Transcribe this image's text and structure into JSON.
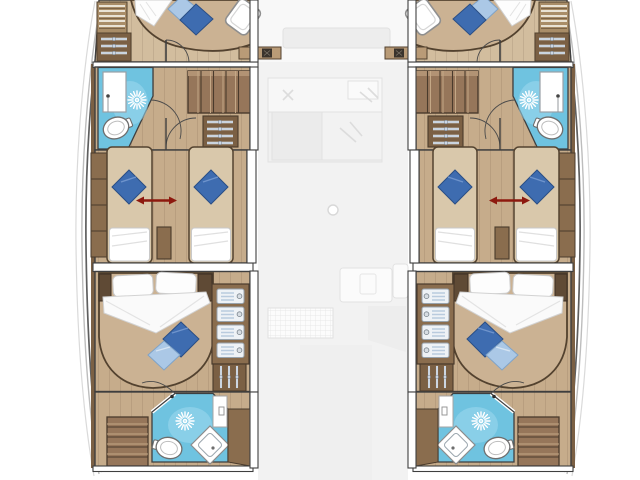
{
  "diagram": {
    "kind": "yacht-floor-plan",
    "vessel": "catamaran",
    "view": "lower deck, top view",
    "layout": "4 cabins / 4 bathrooms, symmetric port and starboard hulls, center saloon shown faded"
  },
  "colors": {
    "background": "#ffffff",
    "floor_wood": "#c6ac8b",
    "floor_wood_light": "#d2bd9e",
    "bed_platform": "#cbb293",
    "mattress_tan": "#d9c8ab",
    "furniture_wood": "#8a6d4e",
    "locker_wood": "#7b6044",
    "stairs_wood": "#96765a",
    "stairs_light": "#b29374",
    "wood_dark_line": "#53422f",
    "wall_line": "#3f3f3f",
    "hull_line": "#5f5f5f",
    "bathroom_floor": "#6fc3e0",
    "bathroom_floor_light": "#9fd9ee",
    "pillow_dark_blue": "#3e6cb0",
    "pillow_dark_blue_edge": "#2a4e85",
    "pillow_light_blue": "#abc8e6",
    "pillow_light_blue_edge": "#7fa3c8",
    "bedding_white": "#ffffff",
    "fixture_stroke": "#6e6e6e",
    "arrow_red": "#8d190e",
    "ghost_fill": "#f2f2f2",
    "ghost_stroke": "#e1e1e1"
  },
  "plan": {
    "port_hull": {
      "forward_cabin": {
        "bed": "island double, angled toward bow",
        "pillows": [
          "light-blue",
          "dark-blue"
        ],
        "storage": [
          "shelf locker",
          "hanging locker"
        ],
        "extras": [
          "forepeak hatch",
          "deck vent step"
        ]
      },
      "forward_bathroom": {
        "fixtures": [
          "shower column",
          "shower spray",
          "toilet"
        ],
        "floor": "blue tile"
      },
      "companionway": {
        "fixtures": [
          "stairs from saloon",
          "hanging locker",
          "door arcs"
        ]
      },
      "twin_cabin": {
        "beds": 2,
        "convertible": true,
        "indicator": "red double arrow (beds slide together)",
        "fixtures": [
          "nightstand",
          "side lockers"
        ]
      },
      "aft_cabin": {
        "bed": "island double, angled toward stern",
        "pillows": [
          "dark-blue",
          "light-blue",
          "2 white head pillows"
        ],
        "storage": [
          "4 cubby shelves with latches",
          "hanging locker"
        ]
      },
      "aft_bathroom": {
        "fixtures": [
          "shower spray",
          "toilet",
          "diamond vanity sink",
          "counter"
        ],
        "floor": "blue tile",
        "extras": [
          "transom stairs",
          "door arc"
        ]
      }
    },
    "starboard_hull": "mirror image of port hull",
    "center_deck_faded": {
      "items": [
        "saloon seating and galley (ghosted)",
        "mast step circle",
        "cockpit grating",
        "cockpit furniture (ghosted)"
      ]
    }
  }
}
